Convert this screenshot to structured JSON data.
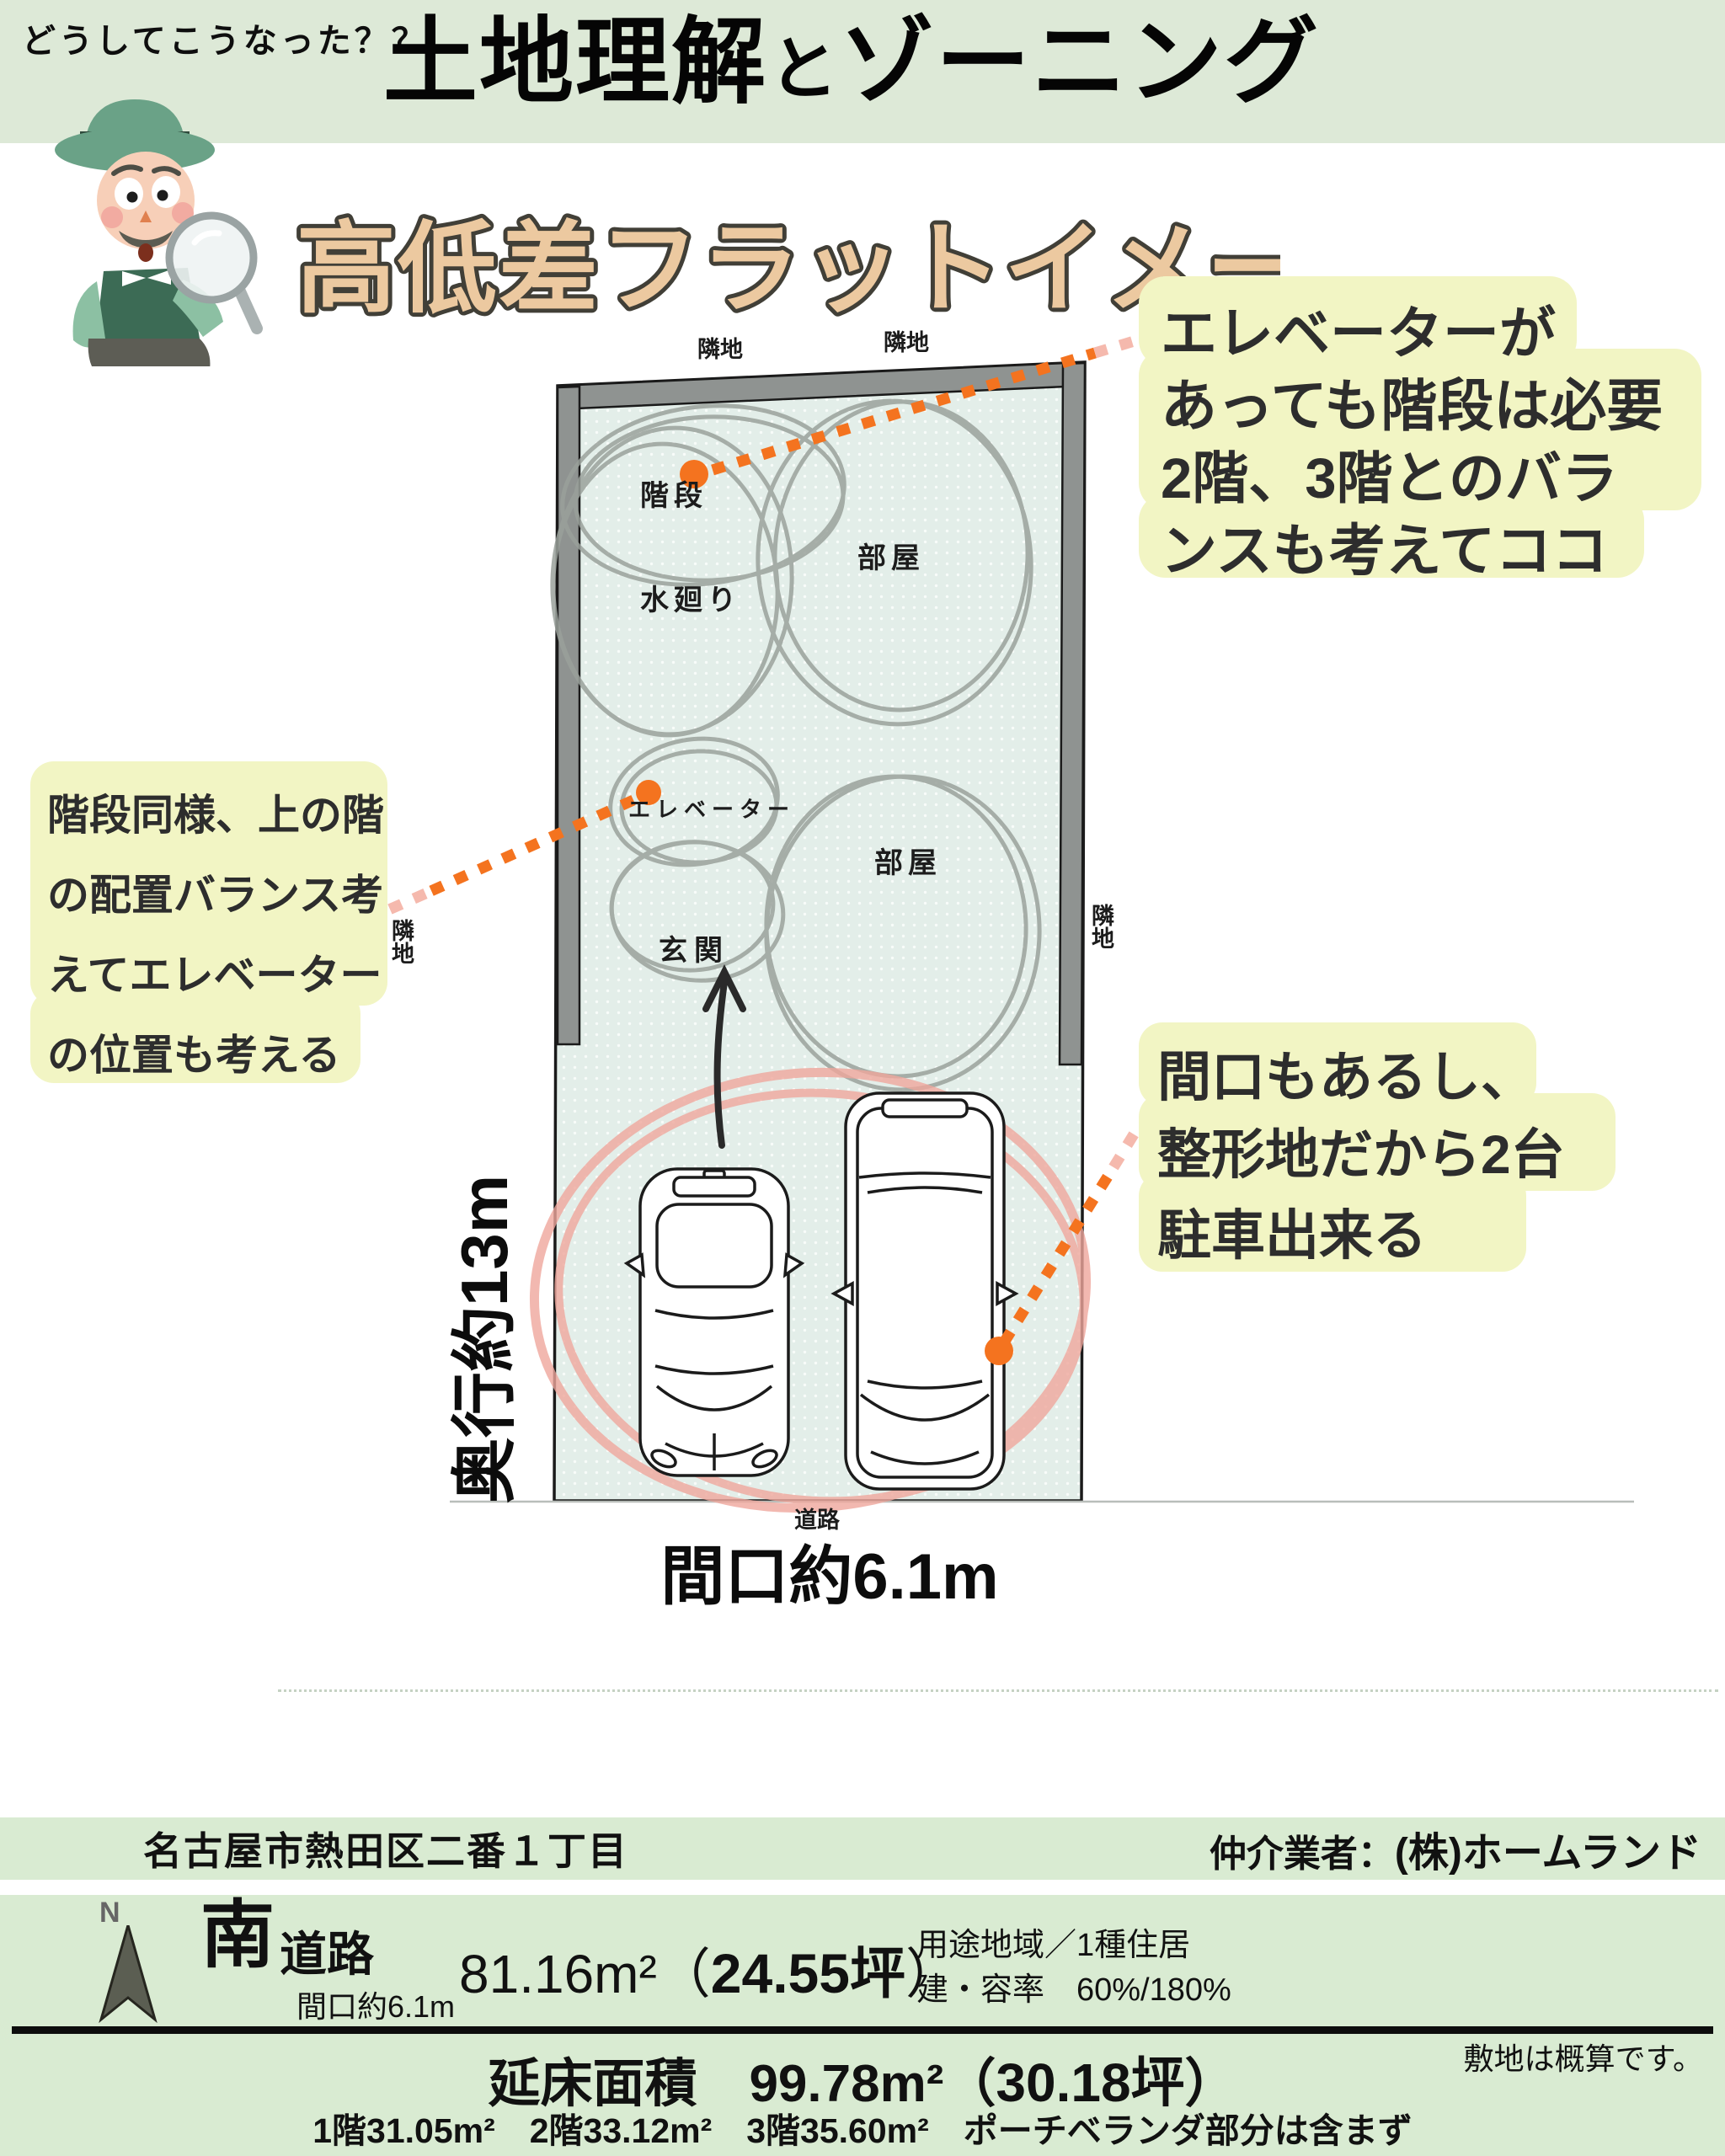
{
  "header": {
    "eyebrow": "どうしてこうなった？？",
    "title_main1": "土地理解",
    "title_conn": "と",
    "title_main2": "ゾーニング",
    "subtitle": "高低差フラットイメージ"
  },
  "plan": {
    "neighbor_top_left": "隣地",
    "neighbor_top_right": "隣地",
    "neighbor_left": "隣地",
    "neighbor_right": "隣地",
    "room_stairs": "階段",
    "room_water": "水廻り",
    "room_upper": "部屋",
    "room_elevator": "エレベーター",
    "room_entrance": "玄関",
    "room_lower": "部屋",
    "road": "道路",
    "frontage": "間口約6.1m",
    "depth": "奥行約13m"
  },
  "notes": {
    "elevator_stairs": [
      "エレベーターが",
      "あっても階段は必要",
      "2階、3階とのバラ",
      "ンスも考えてココ"
    ],
    "elevator_position": [
      "階段同様、上の階",
      "の配置バランス考",
      "えてエレベーター",
      "の位置も考える"
    ],
    "parking": [
      "間口もあるし、",
      "整形地だから2台",
      "駐車出来る"
    ]
  },
  "footer": {
    "address": "名古屋市熱田区二番１丁目",
    "agent_label": "仲介業者：",
    "agent_name": "(株)ホームランド",
    "compass_n": "N",
    "direction_main": "南",
    "direction_sub": "道路",
    "frontage_note": "間口約6.1m",
    "land_area": "81.16m²（",
    "land_tsubo": "24.55坪",
    "land_close": "）",
    "zoning_use": "用途地域／1種住居",
    "zoning_ratio": "建・容率　60%/180%",
    "total_label_area": "延床面積　99.78m²（",
    "total_tsubo": "30.18坪",
    "total_close": "）",
    "survey_note": "敷地は概算です。",
    "floor_breakdown": "1階31.05m²　2階33.12m²　3階35.60m²　ポーチベランダ部分は含まず"
  },
  "colors": {
    "header_green": "#dde9d7",
    "footer_green": "#d9ebd2",
    "plan_fill": "#e3eee9",
    "wall_gray": "#8f9391",
    "sketch_gray": "#9aa19b",
    "accent_orange": "#f4731f",
    "parking_pink": "#efa79d",
    "note_yellow": "#f2f5c4"
  }
}
